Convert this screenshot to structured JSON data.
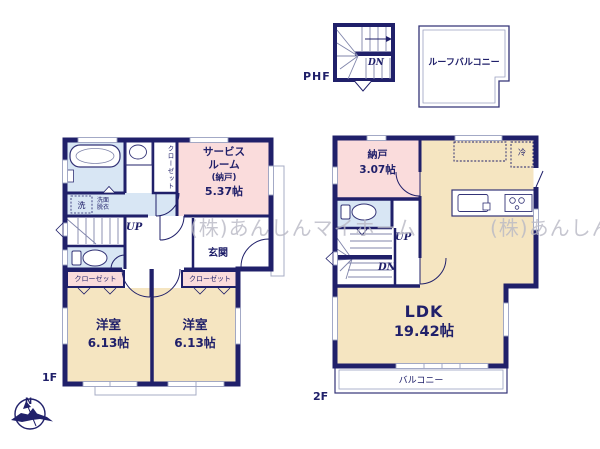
{
  "colors": {
    "wall": "#20206a",
    "room_beige": "#f5e5c1",
    "room_pink": "#fadcdc",
    "room_blue": "#d8e6f4",
    "watermark_gray": "#b9b9c5"
  },
  "watermark": {
    "text": "(株)あんしんマイホーム"
  },
  "phf": {
    "label": "PHF",
    "stairs_dn": "DN",
    "roof_balcony": "ルーフバルコニー"
  },
  "floor1": {
    "label": "1F",
    "closet_vertical": "クローゼット",
    "service_room": {
      "line1": "サービス",
      "line2": "ルーム",
      "line3": "(納戸)",
      "line4": "5.37帖"
    },
    "washer": "洗",
    "washroom": {
      "line1": "洗面",
      "line2": "脱衣"
    },
    "stairs_up": "UP",
    "entrance": "玄関",
    "closet_left": "クローゼット",
    "closet_right": "クローゼット",
    "bedroom_left": {
      "name": "洋室",
      "size": "6.13帖"
    },
    "bedroom_right": {
      "name": "洋室",
      "size": "6.13帖"
    }
  },
  "floor2": {
    "label": "2F",
    "storage": {
      "name": "納戸",
      "size": "3.07帖"
    },
    "fridge": "冷",
    "stairs_up": "UP",
    "stairs_dn": "DN",
    "ldk": {
      "name": "LDK",
      "size": "19.42帖"
    },
    "balcony": "バルコニー"
  },
  "compass": {
    "north": "N"
  }
}
